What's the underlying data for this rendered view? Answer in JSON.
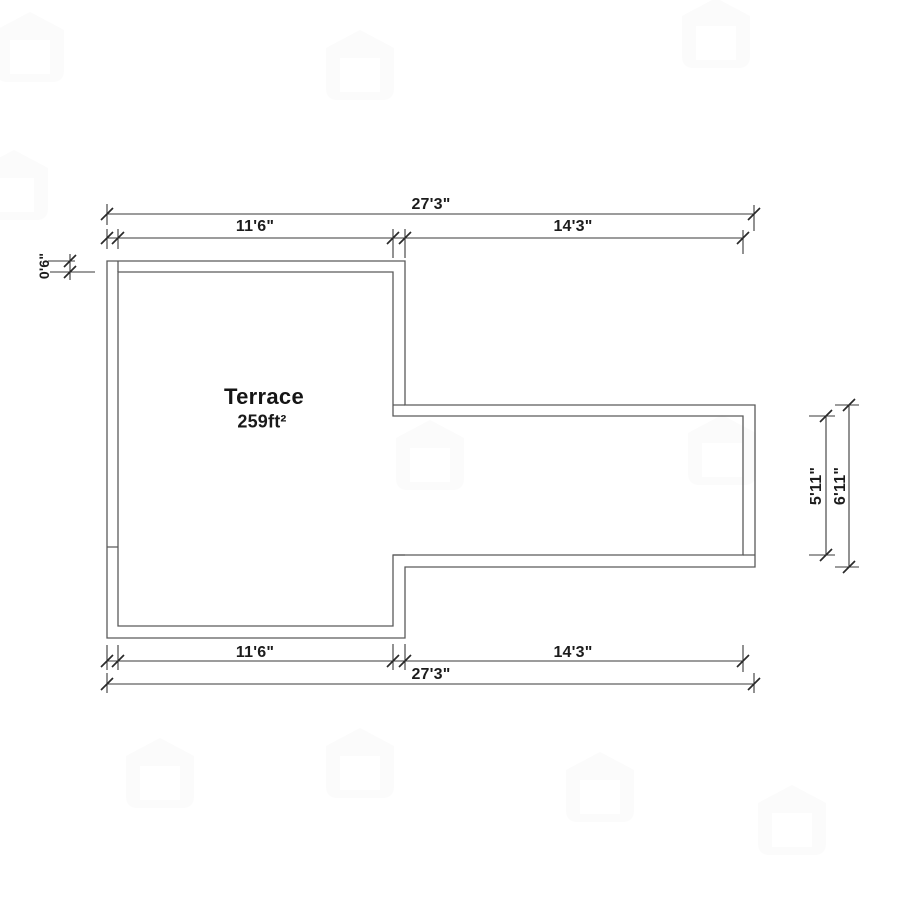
{
  "plan": {
    "room": {
      "name": "Terrace",
      "area": "259ft²"
    },
    "dimensions": {
      "top_total": "27'3\"",
      "top_left": "11'6\"",
      "top_right": "14'3\"",
      "bottom_left": "11'6\"",
      "bottom_right": "14'3\"",
      "bottom_total": "27'3\"",
      "wall_thickness": "0'6\"",
      "right_inner_height": "5'11\"",
      "right_outer_height": "6'11\""
    },
    "colors": {
      "wall_line": "#5a5a5a",
      "dim_line": "#3a3a3a",
      "tick": "#2a2a2a",
      "text": "#1c1c1c",
      "watermark": "#9a9a9a"
    }
  }
}
